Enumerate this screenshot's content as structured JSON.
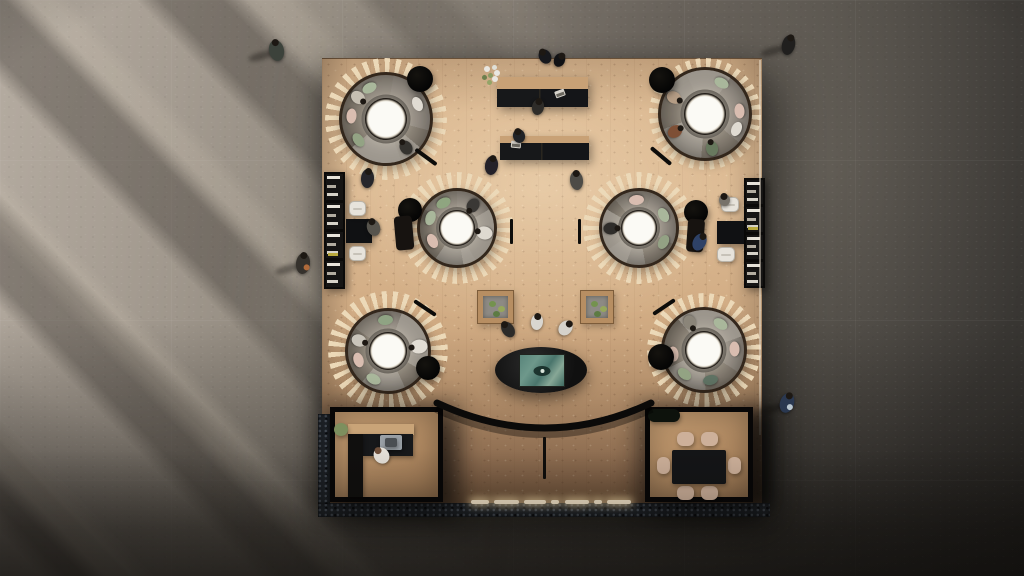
{
  "meta": {
    "view": "top-down architectural rendering of a co-working lounge on a square wood platform"
  },
  "scene": {
    "stage": {
      "w": 1024,
      "h": 576
    },
    "palette": {
      "concrete_light": "#b5aca1",
      "concrete_dark": "#32302d",
      "wood": "#d8b48c",
      "wood_dark": "#93704f",
      "pod_slat": "#ecd9b8",
      "pod_rim": "#33271c",
      "sofa": "#8d867c",
      "carpet": "#6e6861",
      "black": "#0b0a09",
      "cushion_green": "#a9b79b",
      "cushion_pink": "#d9bdb0",
      "chair_white": "#e7e3db",
      "chair_beige": "#cdb09a",
      "screen_teal": "#4f7d74",
      "light_warm": "#f6e7cb"
    },
    "platform": {
      "x": 322,
      "y": 58,
      "w": 440,
      "h": 450
    },
    "pods": [
      {
        "cx": 386,
        "cy": 119,
        "rim": 47,
        "ring": 61,
        "from": 10,
        "slice": {
          "from": 130,
          "size": 100
        },
        "items": [
          {
            "ang": 175,
            "c": "#d9bdb0"
          },
          {
            "ang": 118,
            "c": "#a9b79b"
          },
          {
            "ang": 217,
            "c": "#93a384"
          },
          {
            "ang": 25,
            "c": "#e0dbd2"
          },
          {
            "ang": 305,
            "c": "#35332f",
            "person": true
          },
          {
            "ang": 142,
            "c": "#c6bfb2",
            "person": true
          }
        ]
      },
      {
        "cx": 705,
        "cy": 114,
        "rim": 47,
        "ring": 56,
        "from": 35,
        "slice": {
          "from": 300,
          "size": 95
        },
        "items": [
          {
            "ang": 62,
            "c": "#a9b79b"
          },
          {
            "ang": 5,
            "c": "#d9bdb0"
          },
          {
            "ang": 152,
            "c": "#b59d85",
            "person": true
          },
          {
            "ang": 210,
            "c": "#7e4f35",
            "person": true
          },
          {
            "ang": 282,
            "c": "#68795e",
            "person": true
          },
          {
            "ang": 335,
            "c": "#e0dbd2"
          }
        ]
      },
      {
        "cx": 457,
        "cy": 228,
        "rim": 40,
        "ring": 56,
        "from": 0,
        "slice": {
          "from": 60,
          "size": 110
        },
        "items": [
          {
            "ang": 160,
            "c": "#a9b79b"
          },
          {
            "ang": 207,
            "c": "#d9bdb0"
          },
          {
            "ang": 118,
            "c": "#8fa580"
          },
          {
            "ang": 350,
            "c": "#ded9d0",
            "person": true,
            "w": 13,
            "h": 16
          },
          {
            "ang": 55,
            "c": "#3a3835",
            "person": true
          }
        ]
      },
      {
        "cx": 639,
        "cy": 228,
        "rim": 40,
        "ring": 56,
        "from": 20,
        "slice": {
          "from": 200,
          "size": 100
        },
        "items": [
          {
            "ang": 28,
            "c": "#a9b79b"
          },
          {
            "ang": 330,
            "c": "#93a184"
          },
          {
            "ang": 182,
            "c": "#2f2d2a",
            "person": true
          },
          {
            "ang": 95,
            "c": "#d9bdb0"
          }
        ]
      },
      {
        "cx": 388,
        "cy": 351,
        "rim": 43,
        "ring": 60,
        "from": 5,
        "slice": {
          "from": 20,
          "size": 100
        },
        "items": [
          {
            "ang": 95,
            "c": "#8fa383"
          },
          {
            "ang": 197,
            "c": "#d9bdb0"
          },
          {
            "ang": 243,
            "c": "#a9b79b"
          },
          {
            "ang": 8,
            "c": "#e2ddd4",
            "person": true,
            "w": 14,
            "h": 17
          },
          {
            "ang": 160,
            "c": "#c9c4ba",
            "person": true
          }
        ]
      },
      {
        "cx": 704,
        "cy": 350,
        "rim": 43,
        "ring": 57,
        "from": 28,
        "slice": {
          "from": 320,
          "size": 110
        },
        "items": [
          {
            "ang": 57,
            "c": "#a9b79b"
          },
          {
            "ang": 2,
            "c": "#d9bdb0"
          },
          {
            "ang": 282,
            "c": "#5f7263"
          },
          {
            "ang": 232,
            "c": "#93a383"
          },
          {
            "ang": 187,
            "c": "#d3b8aa"
          },
          {
            "ang": 117,
            "c": "#8b8579",
            "person": true
          }
        ]
      }
    ],
    "dots": [
      {
        "x": 420,
        "y": 79,
        "r": 13
      },
      {
        "x": 662,
        "y": 80,
        "r": 13
      },
      {
        "x": 410,
        "y": 210,
        "r": 12
      },
      {
        "x": 696,
        "y": 212,
        "r": 12
      },
      {
        "x": 428,
        "y": 368,
        "r": 12
      },
      {
        "x": 661,
        "y": 357,
        "r": 13
      }
    ],
    "benches": [
      {
        "x": 426,
        "y": 157,
        "rot": 36
      },
      {
        "x": 661,
        "y": 156,
        "rot": 40
      },
      {
        "x": 425,
        "y": 308,
        "rot": 34
      },
      {
        "x": 664,
        "y": 307,
        "rot": -34
      }
    ],
    "marks": [
      {
        "x": 510,
        "y": 219,
        "h": 25
      },
      {
        "x": 578,
        "y": 219,
        "h": 25
      },
      {
        "x": 543,
        "y": 437,
        "h": 42
      }
    ],
    "lounges": [
      {
        "x": 395,
        "y": 216,
        "w": 18,
        "h": 34,
        "rot": -5
      },
      {
        "x": 687,
        "y": 219,
        "w": 17,
        "h": 33,
        "rot": 4
      }
    ],
    "planters": [
      {
        "x": 477,
        "y": 290,
        "w": 37,
        "h": 34
      },
      {
        "x": 580,
        "y": 290,
        "w": 34,
        "h": 34
      }
    ],
    "desks": [
      {
        "x": 497,
        "y": 77,
        "w": 91,
        "h": 30,
        "band": 12
      },
      {
        "x": 500,
        "y": 136,
        "w": 89,
        "h": 24,
        "band": 7
      }
    ],
    "laptops": [
      {
        "x": 555,
        "y": 90,
        "rot": -20
      },
      {
        "x": 511,
        "y": 141,
        "rot": 5
      }
    ],
    "flowers": {
      "cx": 492,
      "cy": 75,
      "petals": [
        {
          "dx": -5,
          "dy": -6,
          "r": 3,
          "c": "#e9e7e1"
        },
        {
          "dx": 2,
          "dy": -8,
          "r": 2.5,
          "c": "#dfe0d8"
        },
        {
          "dx": 5,
          "dy": -2,
          "r": 3,
          "c": "#e9e7e1"
        },
        {
          "dx": -2,
          "dy": 0,
          "r": 2.5,
          "c": "#8a9a63"
        },
        {
          "dx": -8,
          "dy": 2,
          "r": 2.5,
          "c": "#6d7f4e"
        },
        {
          "dx": 3,
          "dy": 4,
          "r": 3,
          "c": "#e9e7e1"
        },
        {
          "dx": -3,
          "dy": 7,
          "r": 2.5,
          "c": "#93a467"
        }
      ]
    },
    "shelves": [
      {
        "x": 324,
        "y": 172,
        "w": 21,
        "h": 117,
        "compartments": 4,
        "accentIndex": 2
      },
      {
        "x": 744,
        "y": 178,
        "w": 21,
        "h": 110,
        "compartments": 4,
        "accentIndex": 1
      }
    ],
    "seating": [
      {
        "table": {
          "x": 346,
          "y": 219,
          "w": 26,
          "h": 24
        },
        "chairs": [
          {
            "x": 349,
            "y": 201,
            "w": 17,
            "h": 15
          },
          {
            "x": 349,
            "y": 246,
            "w": 17,
            "h": 15
          }
        ]
      },
      {
        "table": {
          "x": 717,
          "y": 221,
          "w": 27,
          "h": 23
        },
        "chairs": [
          {
            "x": 721,
            "y": 197,
            "w": 18,
            "h": 15
          },
          {
            "x": 717,
            "y": 247,
            "w": 18,
            "h": 15
          }
        ]
      }
    ],
    "rooms": {
      "left": {
        "name": "office-room",
        "x": 330,
        "y": 407,
        "w": 113,
        "h": 95,
        "items": [
          {
            "n": "kitchen-counter-top",
            "x": 18,
            "y": 17,
            "w": 66,
            "h": 11,
            "c": "#c9a478"
          },
          {
            "n": "kitchen-counter",
            "x": 33,
            "y": 27,
            "w": 50,
            "h": 22,
            "c": "#17181a"
          },
          {
            "n": "sink",
            "x": 50,
            "y": 28,
            "w": 22,
            "h": 15,
            "c": "#9aa0a6",
            "r": 2
          },
          {
            "n": "sink-basin",
            "x": 55,
            "y": 31,
            "w": 12,
            "h": 9,
            "c": "#4a4e52",
            "r": 2
          },
          {
            "n": "cabinet-column",
            "x": 18,
            "y": 27,
            "w": 15,
            "h": 63,
            "c": "#100f0e"
          },
          {
            "n": "plant",
            "x": 4,
            "y": 16,
            "w": 14,
            "h": 13,
            "c": "#7d8f5e",
            "round": true
          }
        ]
      },
      "right": {
        "name": "meeting-room",
        "x": 645,
        "y": 407,
        "w": 108,
        "h": 95,
        "items": [
          {
            "n": "plant-shelf",
            "x": 3,
            "y": 2,
            "w": 32,
            "h": 13,
            "c": "#0d120c",
            "r": 7
          },
          {
            "n": "dining-chair",
            "x": 32,
            "y": 25,
            "w": 17,
            "h": 14,
            "c": "#cdb09a",
            "r": 6
          },
          {
            "n": "dining-chair",
            "x": 56,
            "y": 25,
            "w": 17,
            "h": 14,
            "c": "#cdb09a",
            "r": 6
          },
          {
            "n": "dining-chair",
            "x": 32,
            "y": 79,
            "w": 17,
            "h": 14,
            "c": "#cdb09a",
            "r": 6
          },
          {
            "n": "dining-chair",
            "x": 56,
            "y": 79,
            "w": 17,
            "h": 14,
            "c": "#cdb09a",
            "r": 6
          },
          {
            "n": "dining-chair",
            "x": 12,
            "y": 50,
            "w": 13,
            "h": 17,
            "c": "#cdb09a",
            "r": 6
          },
          {
            "n": "dining-chair",
            "x": 83,
            "y": 50,
            "w": 13,
            "h": 17,
            "c": "#cdb09a",
            "r": 6
          },
          {
            "n": "dining-table",
            "x": 27,
            "y": 43,
            "w": 54,
            "h": 34,
            "c": "#141517",
            "r": 2
          }
        ]
      }
    },
    "oval_table": {
      "cx": 541,
      "cy": 370,
      "rx": 46,
      "ry": 23,
      "screen": {
        "x": 519,
        "y": 354,
        "w": 46,
        "h": 33
      }
    },
    "arc": {
      "path": "M437,403 Q545,453 651,403",
      "width": 7
    },
    "lights": {
      "y": 500,
      "h": 4,
      "segments": [
        [
          471,
          489
        ],
        [
          494,
          519
        ],
        [
          524,
          546
        ],
        [
          551,
          559
        ],
        [
          565,
          589
        ],
        [
          594,
          602
        ],
        [
          607,
          631
        ]
      ]
    },
    "gravel": [
      {
        "x": 318,
        "y": 503,
        "w": 452,
        "h": 14
      },
      {
        "x": 318,
        "y": 414,
        "w": 12,
        "h": 90
      }
    ],
    "shadow_blobs": [
      {
        "x": 748,
        "y": 412,
        "w": 22,
        "h": 92
      }
    ],
    "edge_highlight": {
      "x": 759,
      "y": 60,
      "w": 2,
      "h": 375
    },
    "people": [
      {
        "x": 276,
        "y": 50,
        "w": 15,
        "h": 21,
        "rot": -12,
        "c": "#3c423b",
        "shadow": true
      },
      {
        "x": 788,
        "y": 45,
        "w": 13,
        "h": 20,
        "rot": 14,
        "c": "#201f1e",
        "shadow": true
      },
      {
        "x": 787,
        "y": 403,
        "w": 14,
        "h": 20,
        "rot": 18,
        "c": "#2a3850",
        "shadow": true,
        "accent": "#b9c6cf"
      },
      {
        "x": 303,
        "y": 263,
        "w": 14,
        "h": 21,
        "rot": 6,
        "c": "#35312c",
        "shadow": true,
        "accent": "#b06a3a"
      },
      {
        "x": 545,
        "y": 56,
        "w": 12,
        "h": 15,
        "rot": -30,
        "c": "#17181c"
      },
      {
        "x": 559,
        "y": 60,
        "w": 11,
        "h": 14,
        "rot": 25,
        "c": "#101114"
      },
      {
        "x": 538,
        "y": 107,
        "w": 12,
        "h": 16,
        "rot": 10,
        "c": "#2e2c29"
      },
      {
        "x": 519,
        "y": 136,
        "w": 12,
        "h": 14,
        "rot": -15,
        "c": "#212327"
      },
      {
        "x": 491,
        "y": 165,
        "w": 13,
        "h": 19,
        "rot": 8,
        "c": "#242129"
      },
      {
        "x": 576,
        "y": 180,
        "w": 13,
        "h": 19,
        "rot": -6,
        "c": "#4d4b46"
      },
      {
        "x": 367,
        "y": 178,
        "w": 13,
        "h": 19,
        "rot": 4,
        "c": "#26262b"
      },
      {
        "x": 373,
        "y": 227,
        "w": 13,
        "h": 17,
        "rot": -20,
        "c": "#57544d"
      },
      {
        "x": 699,
        "y": 242,
        "w": 13,
        "h": 18,
        "rot": 28,
        "c": "#2e4166"
      },
      {
        "x": 724,
        "y": 200,
        "w": 11,
        "h": 12,
        "rot": 0,
        "c": "#77726a"
      },
      {
        "x": 508,
        "y": 329,
        "w": 12,
        "h": 17,
        "rot": -35,
        "c": "#2c2b29"
      },
      {
        "x": 537,
        "y": 322,
        "w": 12,
        "h": 16,
        "rot": 8,
        "c": "#d9d6d0"
      },
      {
        "x": 565,
        "y": 328,
        "w": 13,
        "h": 16,
        "rot": 38,
        "c": "#d5d2cb"
      },
      {
        "x": 381,
        "y": 455,
        "w": 15,
        "h": 17,
        "rot": -40,
        "c": "#e5e0d8",
        "head": "#6e4f3a"
      }
    ]
  }
}
